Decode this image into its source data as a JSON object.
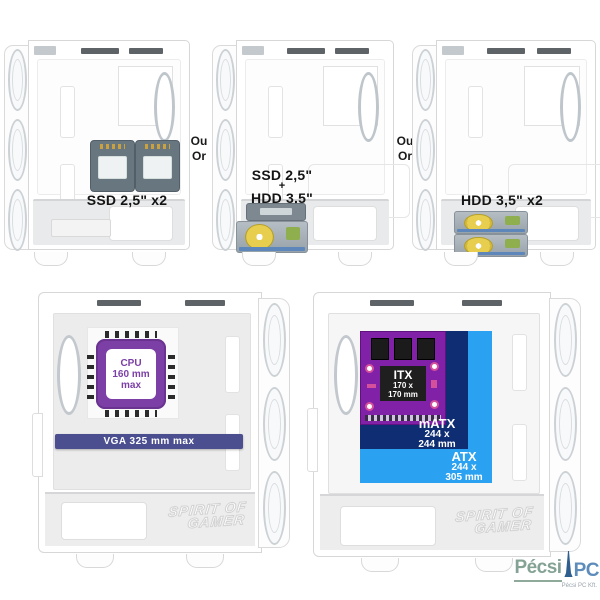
{
  "cases": {
    "top_left": {
      "label": "SSD 2,5\" x2"
    },
    "top_middle": {
      "label_top": "SSD 2,5\"",
      "label_plus": "+",
      "label_bottom": "HDD 3,5\""
    },
    "top_right": {
      "label": "HDD 3,5\" x2"
    },
    "bottom_left": {
      "cpu": {
        "line1": "CPU",
        "line2": "160 mm",
        "line3": "max",
        "color": "#7b3fa6"
      },
      "vga": {
        "label": "VGA 325 mm max",
        "color": "#4b4f90"
      },
      "watermark": {
        "line1": "SPIRIT OF",
        "line2": "GAMER"
      }
    },
    "bottom_right": {
      "itx": {
        "name": "ITX",
        "dim_line1": "170 x",
        "dim_line2": "170 mm",
        "board_color": "#8021a8"
      },
      "matx": {
        "name": "mATX",
        "dim_line1": "244 x",
        "dim_line2": "244 mm",
        "color": "#0e2d72"
      },
      "atx": {
        "name": "ATX",
        "dim_line1": "244 x",
        "dim_line2": "305 mm",
        "color": "#2ba1f1"
      },
      "watermark": {
        "line1": "SPIRIT OF",
        "line2": "GAMER"
      }
    }
  },
  "separators": {
    "or_fr": "Ou",
    "or_en": "Or"
  },
  "logo": {
    "name_part1": "Pécsi",
    "name_part2": "PC",
    "subtext": "Pécsi PC Kft.",
    "green": "#84a394",
    "blue": "#5e8cba"
  }
}
